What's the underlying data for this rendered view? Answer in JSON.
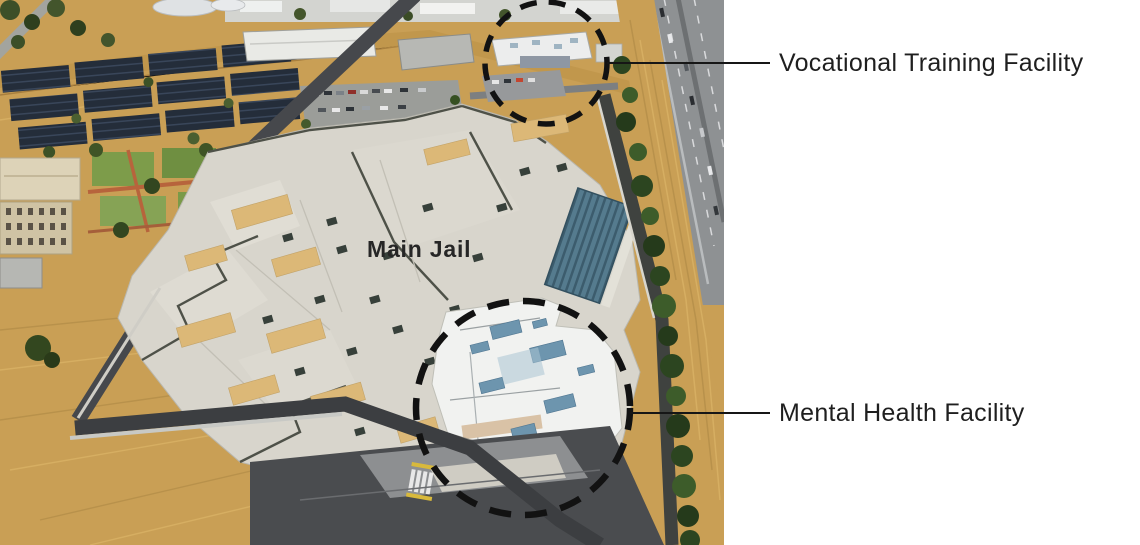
{
  "figure": {
    "type": "annotated-aerial-photograph",
    "photo_alt": "Aerial view of a jail campus beside a highway with dry golden fields",
    "labels": {
      "main_jail": "Main Jail",
      "vocational": "Vocational Training Facility",
      "mental_health": "Mental Health Facility"
    },
    "annotation_style": {
      "circle_color": "#121212",
      "leader_line_color": "#161616",
      "label_color": "#1f1f1f"
    },
    "scene_colors": {
      "background": "#ffffff",
      "dry_grass": "#c99f55",
      "solar_panels": "#242d3a",
      "jail_roof": "#d8d5cc",
      "tan_roof_units": "#dcb877",
      "teal_roof": "#557b8e",
      "mental_health_roof": "#f1f2f0",
      "hvac_blue": "#6d95ae",
      "asphalt": "#46484c",
      "highway": "#8e9193",
      "trees": "#2e4722"
    }
  }
}
